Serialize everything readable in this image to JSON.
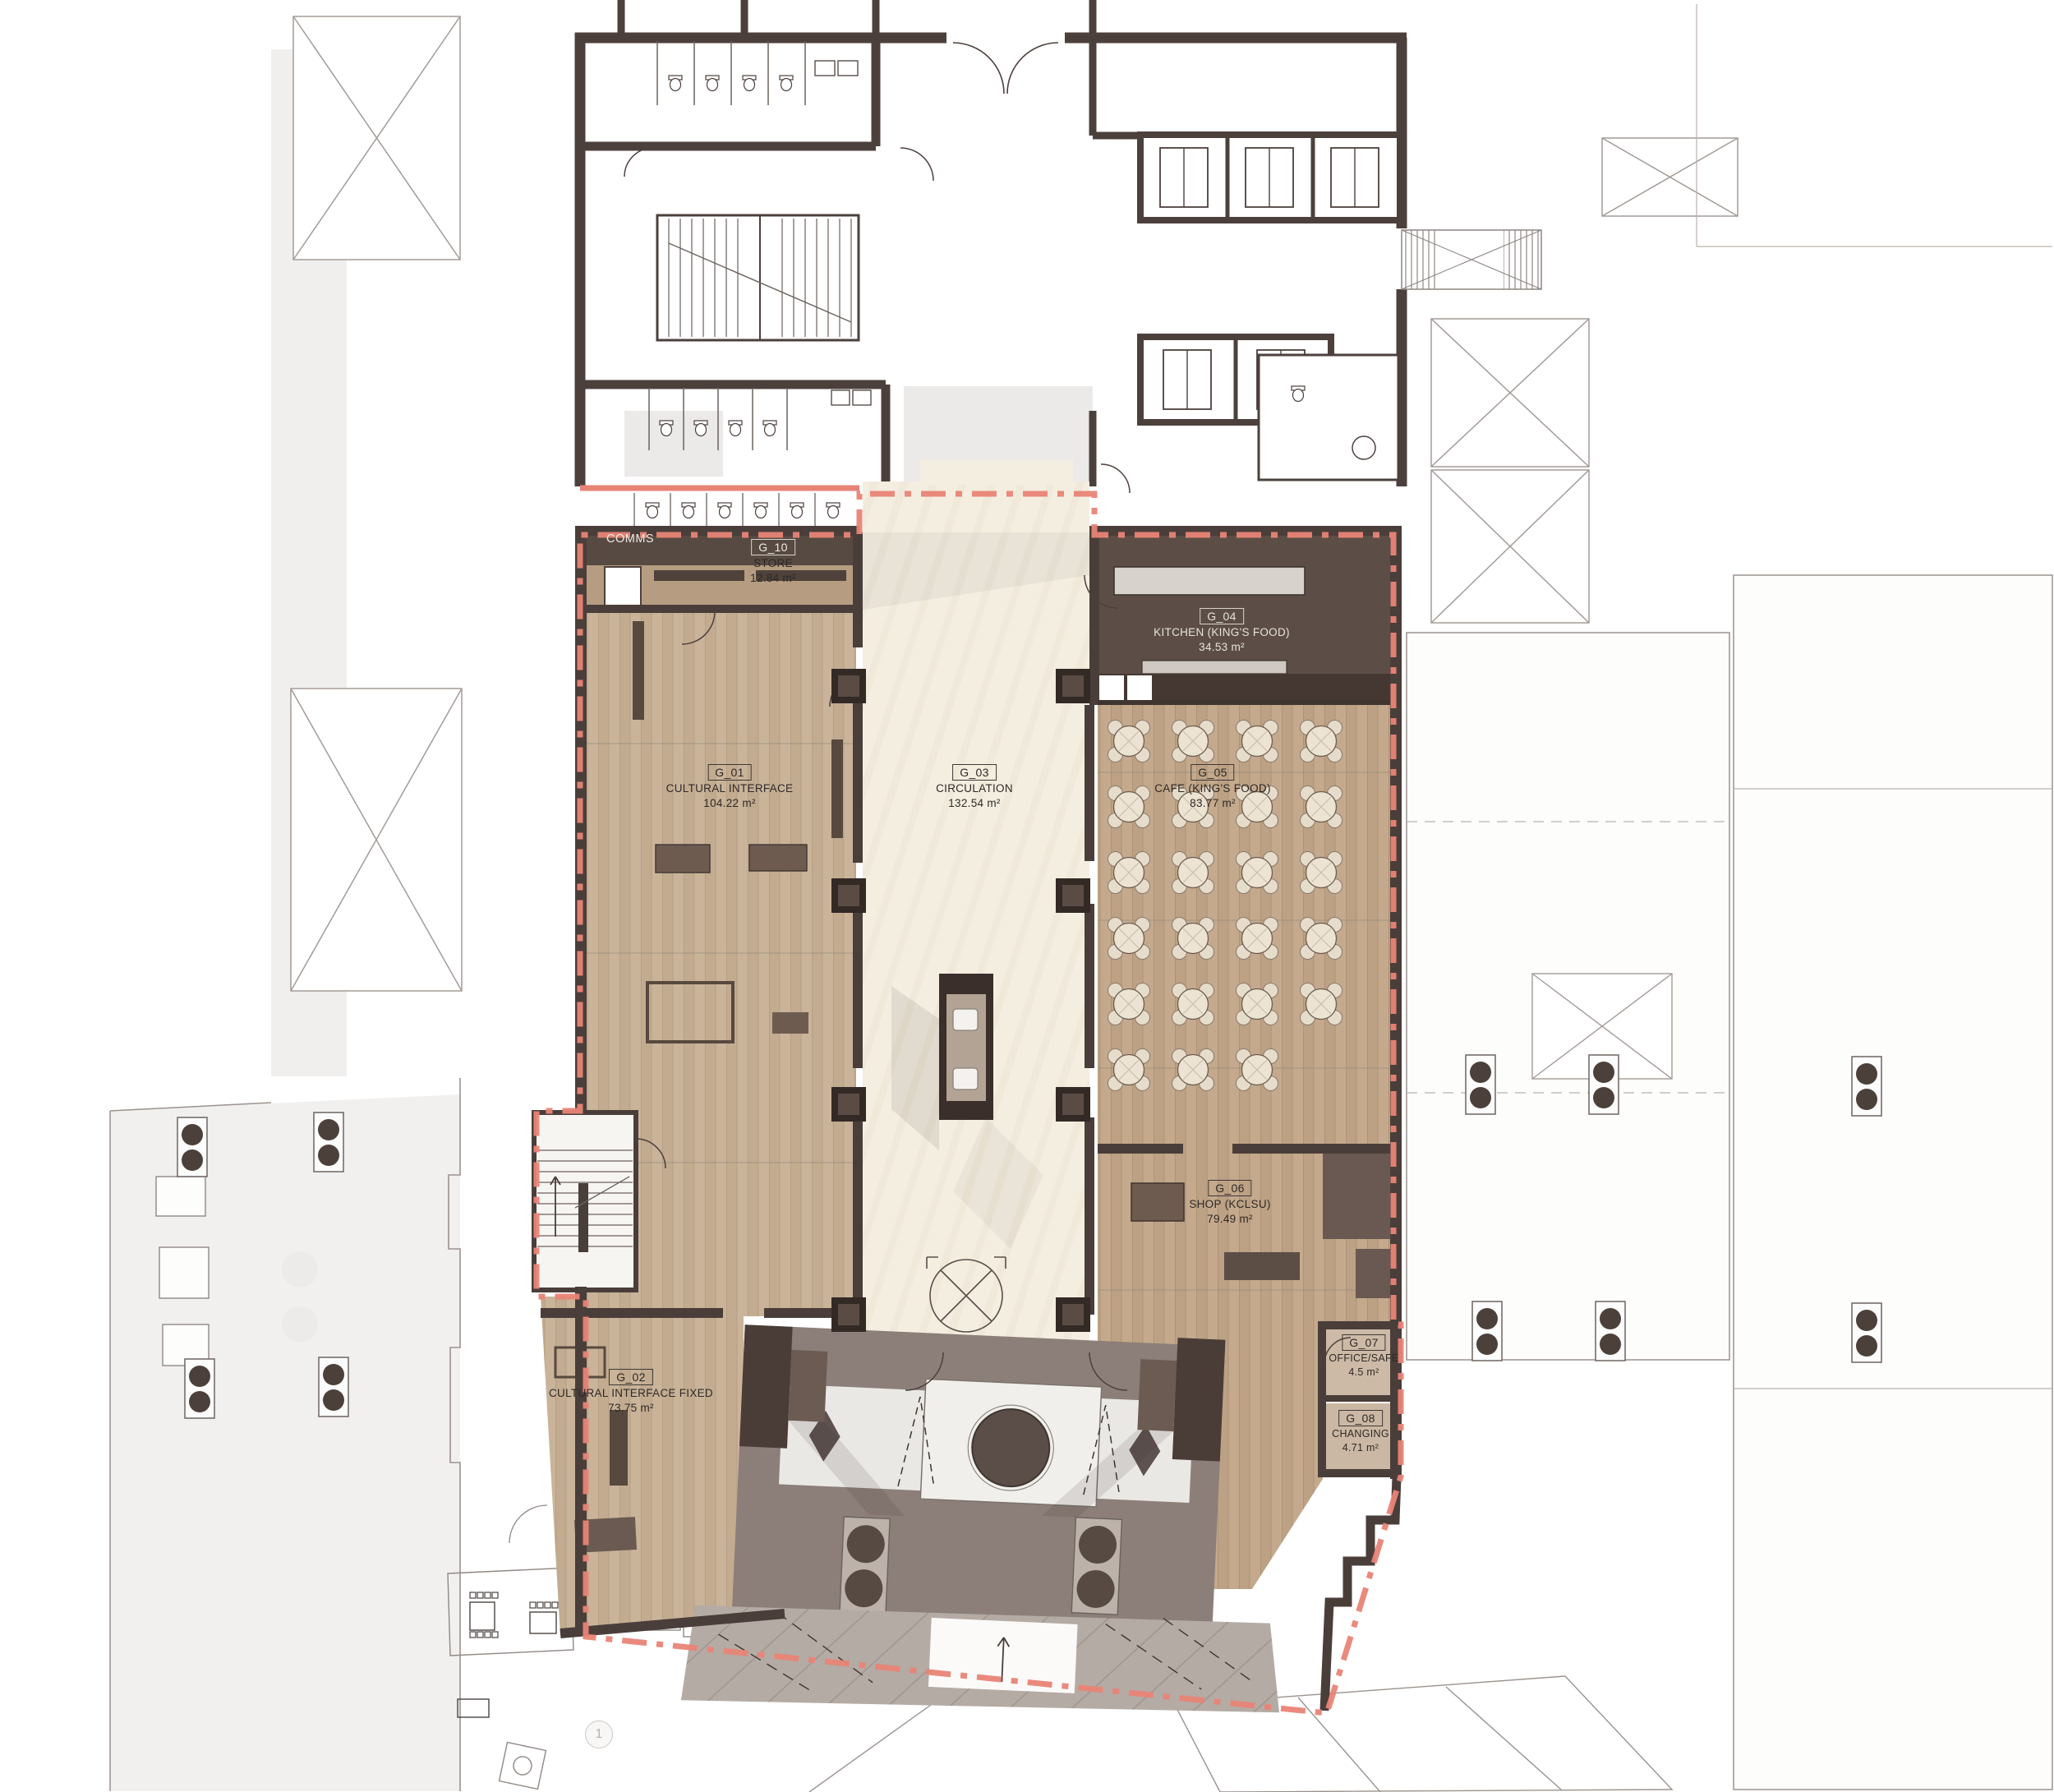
{
  "document": {
    "type": "ground-floor-plan"
  },
  "rooms": [
    {
      "number": "G_01",
      "name": "CULTURAL INTERFACE",
      "area": "104.22 m²"
    },
    {
      "number": "G_02",
      "name": "CULTURAL INTERFACE FIXED",
      "area": "73.75 m²"
    },
    {
      "number": "G_03",
      "name": "CIRCULATION",
      "area": "132.54 m²"
    },
    {
      "number": "G_04",
      "name": "KITCHEN (KING'S FOOD)",
      "area": "34.53 m²"
    },
    {
      "number": "G_05",
      "name": "CAFE (KING'S FOOD)",
      "area": "83.77 m²"
    },
    {
      "number": "G_06",
      "name": "SHOP (KCLSU)",
      "area": "79.49 m²"
    },
    {
      "number": "G_07",
      "name": "OFFICE/SAFE",
      "area": "4.5 m²"
    },
    {
      "number": "G_08",
      "name": "CHANGING",
      "area": "4.71 m²"
    },
    {
      "number": "G_10",
      "name": "STORE",
      "area": "12.84 m²"
    }
  ],
  "annotations": {
    "comms_label": "COMMS",
    "grid_marker": "1"
  },
  "colors": {
    "wall_dark": "#4a3e3a",
    "wood_light": "#c9b49a",
    "wood_cafe": "#c4a98c",
    "circulation_cream": "#f4eee1",
    "kitchen_dark": "#5c4e46",
    "demise_red": "#e88476",
    "entrance_grey": "#8c7f79",
    "marble_white": "#eae8e5",
    "context_grey": "#9a928e"
  }
}
